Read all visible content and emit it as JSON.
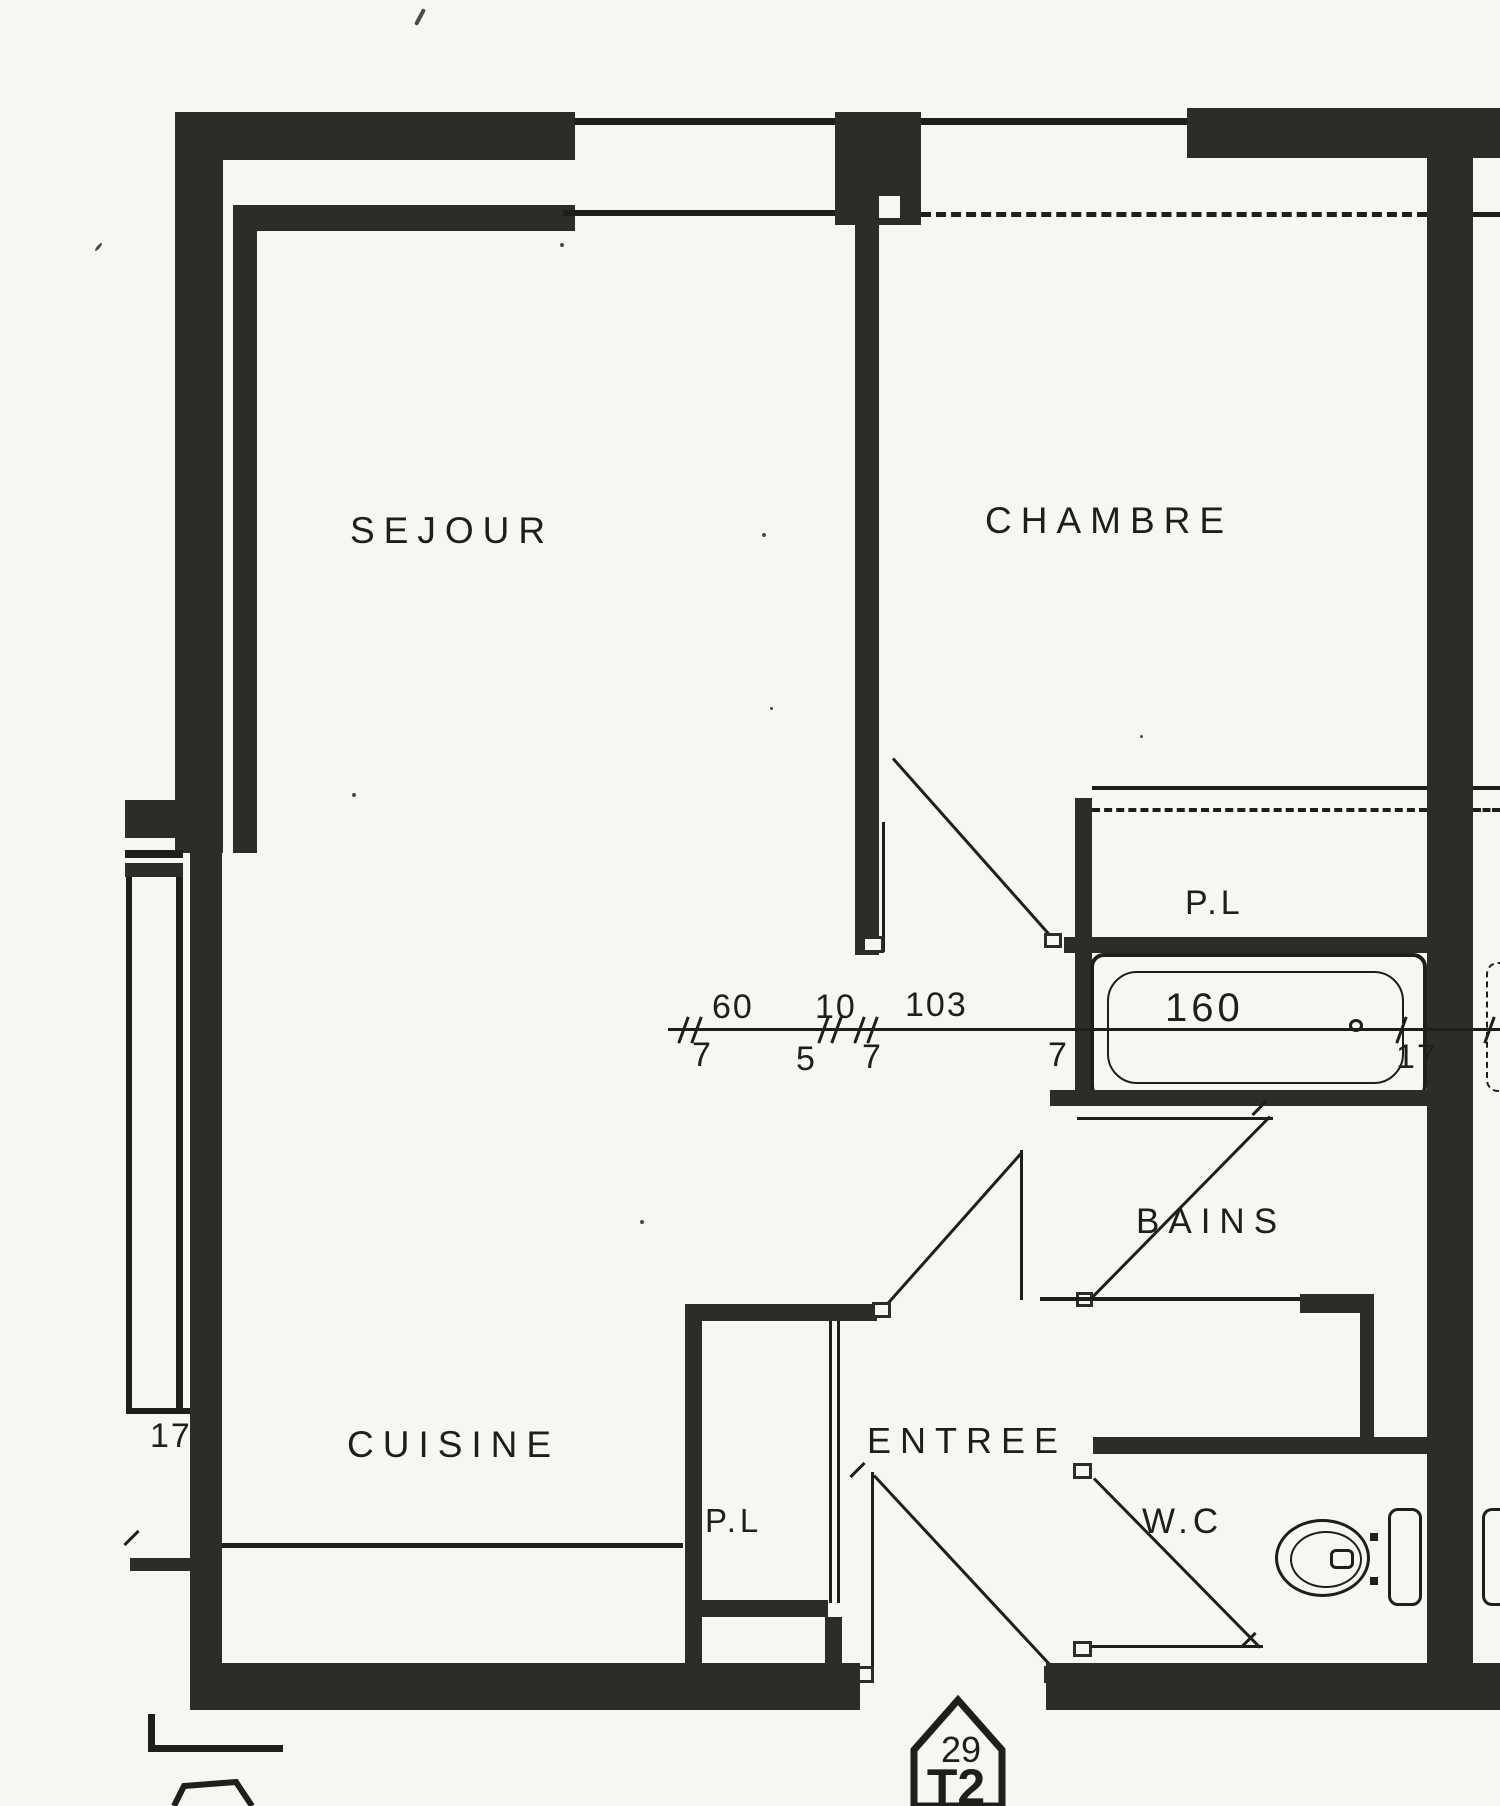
{
  "title": "Plan appartement T2 n°29",
  "colors": {
    "wall": "#2e2c29",
    "ink": "#1f1e1c",
    "paper": "#f7f6f2"
  },
  "rooms": {
    "sejour": "SEJOUR",
    "chambre": "CHAMBRE",
    "cuisine": "CUISINE",
    "entree": "ENTREE",
    "bains": "BAINS",
    "wc": "W.C",
    "placard_bains": "P.L",
    "placard_entree": "P.L"
  },
  "dims": {
    "d60": "60",
    "d10": "10",
    "d103": "103",
    "d160": "160",
    "d7a": "7",
    "d5": "5",
    "d7b": "7",
    "d7c": "7",
    "d17_tub": "17",
    "d17_left": "17"
  },
  "badge": {
    "number": "29",
    "type": "T2"
  }
}
